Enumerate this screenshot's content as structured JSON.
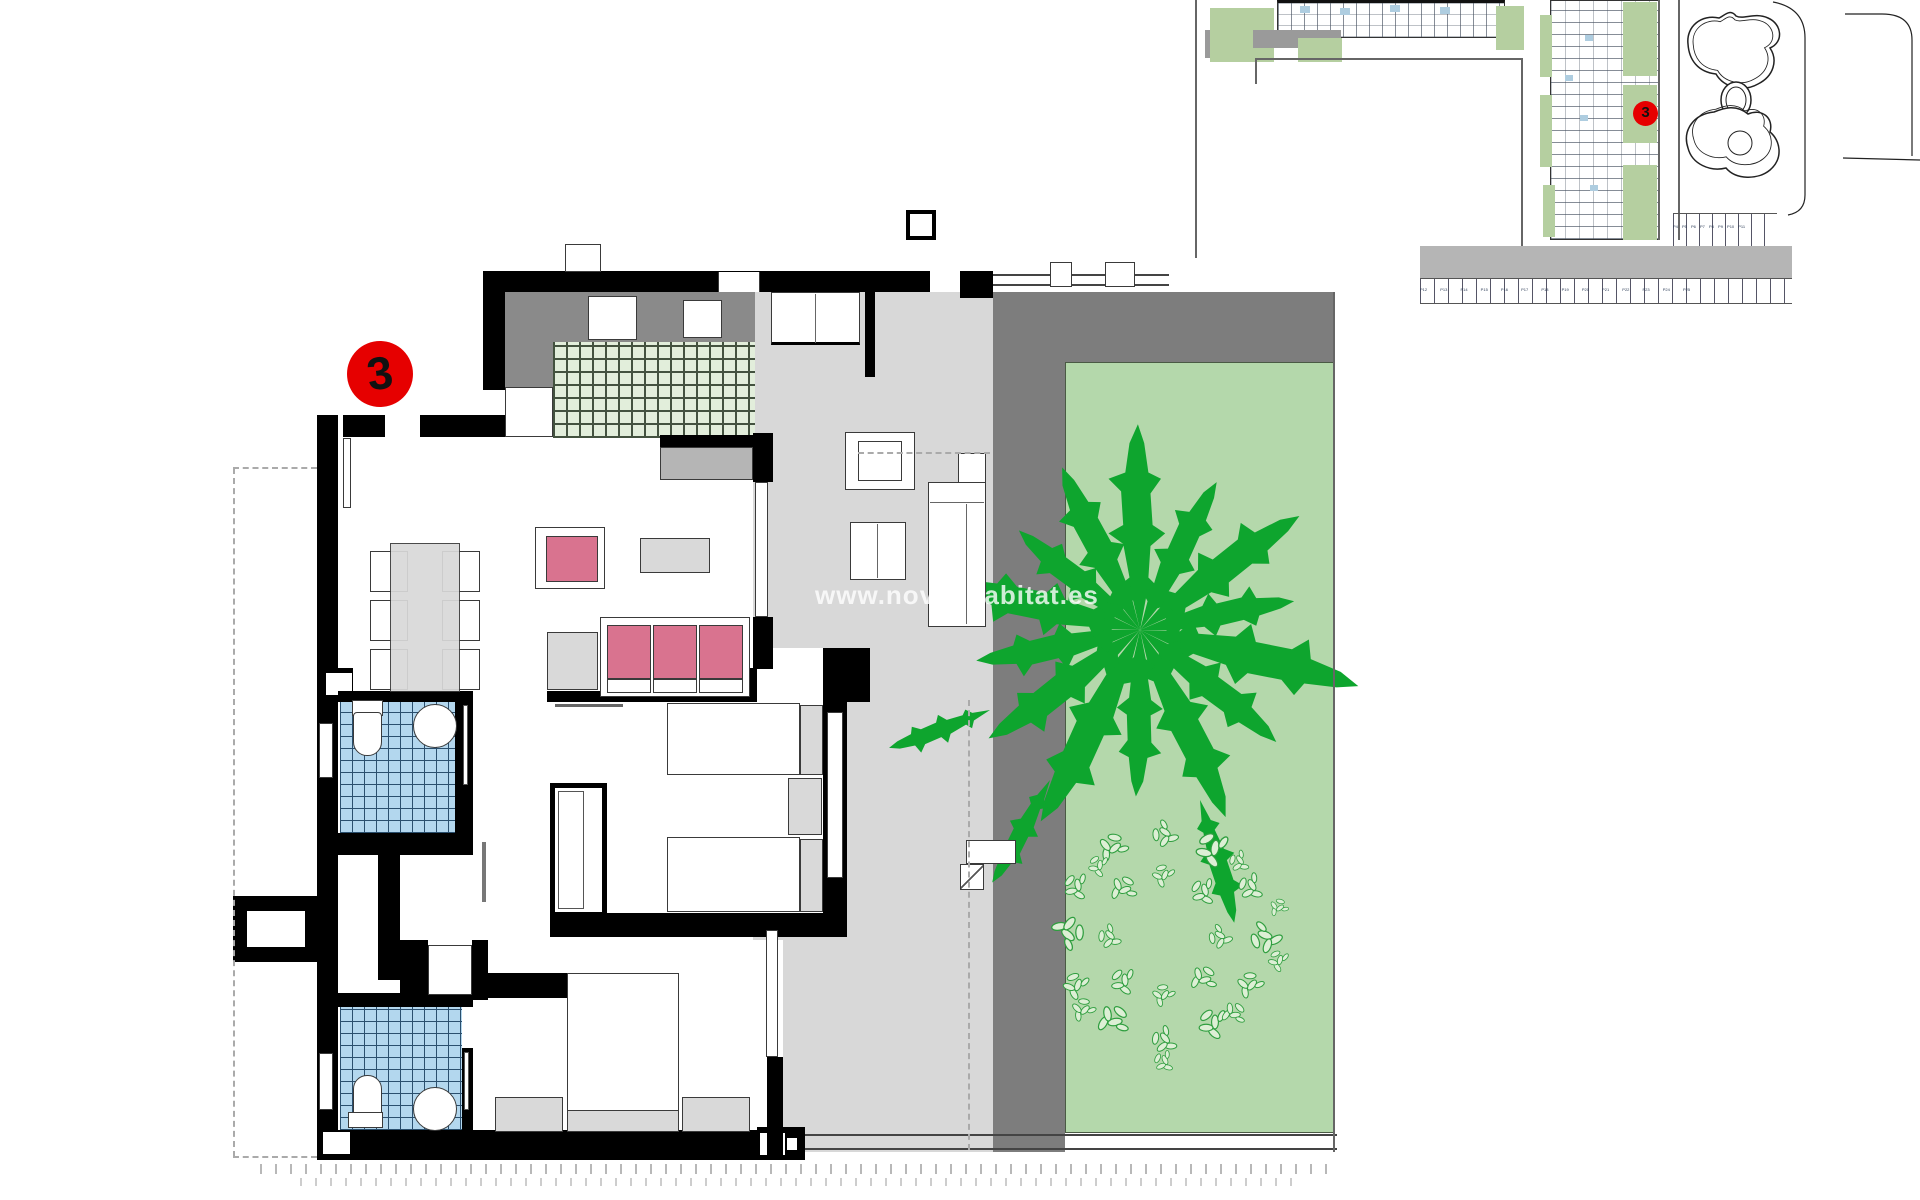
{
  "watermark": {
    "text": "www.novushabitat.es"
  },
  "main_plan": {
    "unit_badge": "3"
  },
  "site_plan": {
    "unit_badge": "3",
    "parking_row_a": "P4 P5 P6 P7 P8 P9 P10 P11",
    "parking_row_b": "P12 P13 P14 P15 P16 P17 P18 P19 P20 P21 P22 P23 P24 P25"
  },
  "colors": {
    "wall": "#000000",
    "terrace": "#d8d8d8",
    "counter_gray": "#8a8a8a",
    "garden_band": "#7d7d7d",
    "lawn": "#b4d8ab",
    "tree_green": "#0ea52e",
    "groundcover_stroke": "#2f9e3f",
    "groundcover_fill": "#ddefd5",
    "tile_green_bg": "#e2eedb",
    "tile_green_line": "#43523f",
    "tile_blue_bg": "#b3d7ee",
    "tile_blue_line": "#2a4f6e",
    "pink": "#d9738f",
    "furniture_gray": "#d9d9d9",
    "outline": "#3a3a3a",
    "badge_red": "#e60000",
    "site_green": "#b5cfa0",
    "site_gray": "#9a9a9a",
    "site_blue": "#aecde0",
    "dashed": "#aaaaaa",
    "fence": "#444444"
  }
}
